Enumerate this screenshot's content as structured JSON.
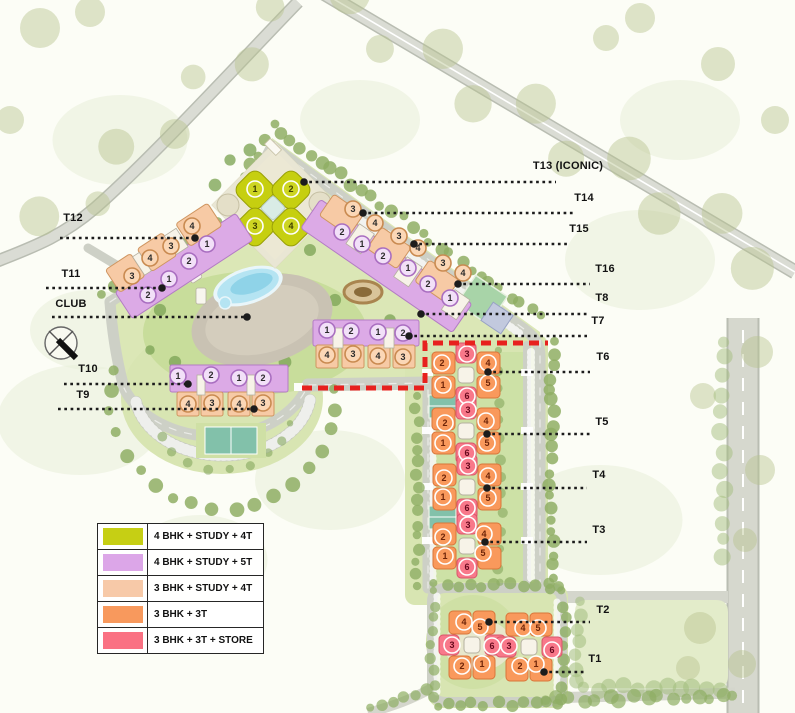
{
  "legend": {
    "items": [
      {
        "label": "4 BHK + STUDY + 4T",
        "color": "#c6cf14"
      },
      {
        "label": "4 BHK + STUDY + 5T",
        "color": "#dca6e8"
      },
      {
        "label": "3 BHK + STUDY + 4T",
        "color": "#f7c9a8"
      },
      {
        "label": "3 BHK + 3T",
        "color": "#f8995d"
      },
      {
        "label": "3 BHK + 3T + STORE",
        "color": "#fa7183"
      }
    ]
  },
  "map": {
    "badge_styles": {
      "y": {
        "fill": "#cdd522",
        "stroke": "#ffffff",
        "text": "#3f3f00"
      },
      "v": {
        "fill": "#f2e0f8",
        "stroke": "#a96ec0",
        "text": "#2b2b2b"
      },
      "p": {
        "fill": "#fbd7b6",
        "stroke": "#c98a50",
        "text": "#2b2b2b"
      },
      "o": {
        "fill": "#f9995c",
        "stroke": "#ffffff",
        "text": "#6e2408"
      },
      "r": {
        "fill": "#f8788a",
        "stroke": "#ffffff",
        "text": "#66081c"
      }
    },
    "leaders": [
      {
        "id": "t13",
        "label": "T13 (ICONIC)",
        "tx": 568,
        "ty": 169,
        "ly": 182,
        "x1": 303,
        "x2": 556,
        "dotx": 304
      },
      {
        "id": "t14",
        "label": "T14",
        "tx": 584,
        "ty": 201,
        "ly": 213,
        "x1": 362,
        "x2": 574,
        "dotx": 363
      },
      {
        "id": "t15",
        "label": "T15",
        "tx": 579,
        "ty": 232,
        "ly": 244,
        "x1": 413,
        "x2": 569,
        "dotx": 414
      },
      {
        "id": "t16",
        "label": "T16",
        "tx": 605,
        "ty": 272,
        "ly": 284,
        "x1": 457,
        "x2": 590,
        "dotx": 458
      },
      {
        "id": "t8",
        "label": "T8",
        "tx": 602,
        "ty": 301,
        "ly": 314,
        "x1": 420,
        "x2": 590,
        "dotx": 421
      },
      {
        "id": "t7",
        "label": "T7",
        "tx": 598,
        "ty": 324,
        "ly": 336,
        "x1": 408,
        "x2": 587,
        "dotx": 409
      },
      {
        "id": "t6",
        "label": "T6",
        "tx": 603,
        "ty": 360,
        "ly": 372,
        "x1": 487,
        "x2": 590,
        "dotx": 488
      },
      {
        "id": "t5",
        "label": "T5",
        "tx": 602,
        "ty": 425,
        "ly": 434,
        "x1": 486,
        "x2": 590,
        "dotx": 487
      },
      {
        "id": "t4",
        "label": "T4",
        "tx": 599,
        "ty": 478,
        "ly": 488,
        "x1": 486,
        "x2": 587,
        "dotx": 487
      },
      {
        "id": "t3",
        "label": "T3",
        "tx": 599,
        "ty": 533,
        "ly": 542,
        "x1": 484,
        "x2": 587,
        "dotx": 485
      },
      {
        "id": "t2",
        "label": "T2",
        "tx": 603,
        "ty": 613,
        "ly": 622,
        "x1": 488,
        "x2": 590,
        "dotx": 489
      },
      {
        "id": "t1",
        "label": "T1",
        "tx": 595,
        "ty": 662,
        "ly": 672,
        "x1": 543,
        "x2": 585,
        "dotx": 544
      },
      {
        "id": "t12",
        "label": "T12",
        "tx": 73,
        "ty": 221,
        "ly": 238,
        "x1": 60,
        "x2": 196,
        "dotx": 195
      },
      {
        "id": "t11",
        "label": "T11",
        "tx": 71,
        "ty": 277,
        "ly": 288,
        "x1": 46,
        "x2": 163,
        "dotx": 162
      },
      {
        "id": "club",
        "label": "CLUB",
        "tx": 71,
        "ty": 307,
        "ly": 317,
        "x1": 52,
        "x2": 248,
        "dotx": 247
      },
      {
        "id": "t10",
        "label": "T10",
        "tx": 88,
        "ty": 372,
        "ly": 384,
        "x1": 64,
        "x2": 189,
        "dotx": 188
      },
      {
        "id": "t9",
        "label": "T9",
        "tx": 83,
        "ty": 398,
        "ly": 409,
        "x1": 58,
        "x2": 255,
        "dotx": 254
      }
    ],
    "towers": [
      {
        "id": "T13",
        "badges": [
          {
            "n": "1",
            "x": 255,
            "y": 189,
            "t": "y"
          },
          {
            "n": "2",
            "x": 291,
            "y": 189,
            "t": "y"
          },
          {
            "n": "3",
            "x": 255,
            "y": 226,
            "t": "y"
          },
          {
            "n": "4",
            "x": 291,
            "y": 226,
            "t": "y"
          }
        ]
      },
      {
        "id": "T14",
        "badges": [
          {
            "n": "3",
            "x": 353,
            "y": 209,
            "t": "p"
          },
          {
            "n": "4",
            "x": 375,
            "y": 223,
            "t": "p"
          },
          {
            "n": "2",
            "x": 342,
            "y": 232,
            "t": "v"
          },
          {
            "n": "1",
            "x": 362,
            "y": 244,
            "t": "v"
          }
        ]
      },
      {
        "id": "T15",
        "badges": [
          {
            "n": "3",
            "x": 399,
            "y": 236,
            "t": "p"
          },
          {
            "n": "4",
            "x": 418,
            "y": 248,
            "t": "p"
          },
          {
            "n": "2",
            "x": 383,
            "y": 256,
            "t": "v"
          },
          {
            "n": "1",
            "x": 408,
            "y": 268,
            "t": "v"
          }
        ]
      },
      {
        "id": "T16",
        "badges": [
          {
            "n": "3",
            "x": 443,
            "y": 263,
            "t": "p"
          },
          {
            "n": "4",
            "x": 463,
            "y": 273,
            "t": "p"
          },
          {
            "n": "2",
            "x": 428,
            "y": 284,
            "t": "v"
          },
          {
            "n": "1",
            "x": 450,
            "y": 298,
            "t": "v"
          }
        ]
      },
      {
        "id": "T12",
        "badges": [
          {
            "n": "4",
            "x": 192,
            "y": 226,
            "t": "p"
          },
          {
            "n": "1",
            "x": 207,
            "y": 244,
            "t": "v"
          },
          {
            "n": "3",
            "x": 171,
            "y": 246,
            "t": "p"
          },
          {
            "n": "2",
            "x": 189,
            "y": 261,
            "t": "v"
          }
        ]
      },
      {
        "id": "T11",
        "badges": [
          {
            "n": "4",
            "x": 150,
            "y": 258,
            "t": "p"
          },
          {
            "n": "3",
            "x": 132,
            "y": 276,
            "t": "p"
          },
          {
            "n": "1",
            "x": 169,
            "y": 279,
            "t": "v"
          },
          {
            "n": "2",
            "x": 148,
            "y": 295,
            "t": "v"
          }
        ]
      },
      {
        "id": "T10",
        "badges": [
          {
            "n": "1",
            "x": 178,
            "y": 376,
            "t": "v"
          },
          {
            "n": "2",
            "x": 211,
            "y": 375,
            "t": "v"
          },
          {
            "n": "4",
            "x": 188,
            "y": 404,
            "t": "p"
          },
          {
            "n": "3",
            "x": 212,
            "y": 403,
            "t": "p"
          }
        ]
      },
      {
        "id": "T9",
        "badges": [
          {
            "n": "1",
            "x": 239,
            "y": 378,
            "t": "v"
          },
          {
            "n": "2",
            "x": 263,
            "y": 378,
            "t": "v"
          },
          {
            "n": "4",
            "x": 239,
            "y": 404,
            "t": "p"
          },
          {
            "n": "3",
            "x": 263,
            "y": 403,
            "t": "p"
          }
        ]
      },
      {
        "id": "T8",
        "badges": [
          {
            "n": "1",
            "x": 327,
            "y": 330,
            "t": "v"
          },
          {
            "n": "2",
            "x": 351,
            "y": 331,
            "t": "v"
          },
          {
            "n": "4",
            "x": 327,
            "y": 355,
            "t": "p"
          },
          {
            "n": "3",
            "x": 353,
            "y": 354,
            "t": "p"
          }
        ]
      },
      {
        "id": "T7",
        "badges": [
          {
            "n": "1",
            "x": 378,
            "y": 332,
            "t": "v"
          },
          {
            "n": "2",
            "x": 403,
            "y": 333,
            "t": "v"
          },
          {
            "n": "4",
            "x": 378,
            "y": 356,
            "t": "p"
          },
          {
            "n": "3",
            "x": 403,
            "y": 357,
            "t": "p"
          }
        ]
      },
      {
        "id": "T6",
        "badges": [
          {
            "n": "3",
            "x": 467,
            "y": 354,
            "t": "r"
          },
          {
            "n": "2",
            "x": 442,
            "y": 363,
            "t": "o"
          },
          {
            "n": "4",
            "x": 488,
            "y": 363,
            "t": "o"
          },
          {
            "n": "1",
            "x": 443,
            "y": 385,
            "t": "o"
          },
          {
            "n": "5",
            "x": 488,
            "y": 383,
            "t": "o"
          },
          {
            "n": "6",
            "x": 467,
            "y": 396,
            "t": "r"
          }
        ]
      },
      {
        "id": "T5",
        "badges": [
          {
            "n": "3",
            "x": 468,
            "y": 410,
            "t": "r"
          },
          {
            "n": "2",
            "x": 445,
            "y": 423,
            "t": "o"
          },
          {
            "n": "4",
            "x": 486,
            "y": 421,
            "t": "o"
          },
          {
            "n": "1",
            "x": 443,
            "y": 443,
            "t": "o"
          },
          {
            "n": "5",
            "x": 487,
            "y": 443,
            "t": "o"
          },
          {
            "n": "6",
            "x": 467,
            "y": 453,
            "t": "r"
          }
        ]
      },
      {
        "id": "T4",
        "badges": [
          {
            "n": "3",
            "x": 468,
            "y": 466,
            "t": "r"
          },
          {
            "n": "2",
            "x": 444,
            "y": 478,
            "t": "o"
          },
          {
            "n": "4",
            "x": 488,
            "y": 476,
            "t": "o"
          },
          {
            "n": "1",
            "x": 443,
            "y": 497,
            "t": "o"
          },
          {
            "n": "5",
            "x": 488,
            "y": 498,
            "t": "o"
          },
          {
            "n": "6",
            "x": 467,
            "y": 508,
            "t": "r"
          }
        ]
      },
      {
        "id": "T3",
        "badges": [
          {
            "n": "3",
            "x": 468,
            "y": 525,
            "t": "r"
          },
          {
            "n": "2",
            "x": 443,
            "y": 537,
            "t": "o"
          },
          {
            "n": "4",
            "x": 484,
            "y": 534,
            "t": "o"
          },
          {
            "n": "1",
            "x": 445,
            "y": 556,
            "t": "o"
          },
          {
            "n": "5",
            "x": 483,
            "y": 553,
            "t": "o"
          },
          {
            "n": "6",
            "x": 467,
            "y": 567,
            "t": "r"
          }
        ]
      },
      {
        "id": "T2",
        "badges": [
          {
            "n": "4",
            "x": 464,
            "y": 622,
            "t": "o"
          },
          {
            "n": "5",
            "x": 480,
            "y": 627,
            "t": "o"
          },
          {
            "n": "3",
            "x": 452,
            "y": 645,
            "t": "r"
          },
          {
            "n": "6",
            "x": 492,
            "y": 646,
            "t": "r"
          },
          {
            "n": "2",
            "x": 462,
            "y": 666,
            "t": "o"
          },
          {
            "n": "1",
            "x": 482,
            "y": 664,
            "t": "o"
          }
        ]
      },
      {
        "id": "T1",
        "badges": [
          {
            "n": "4",
            "x": 523,
            "y": 628,
            "t": "o"
          },
          {
            "n": "5",
            "x": 538,
            "y": 628,
            "t": "o"
          },
          {
            "n": "3",
            "x": 509,
            "y": 646,
            "t": "r"
          },
          {
            "n": "6",
            "x": 552,
            "y": 650,
            "t": "r"
          },
          {
            "n": "2",
            "x": 520,
            "y": 666,
            "t": "o"
          },
          {
            "n": "1",
            "x": 536,
            "y": 664,
            "t": "o"
          }
        ]
      }
    ]
  }
}
